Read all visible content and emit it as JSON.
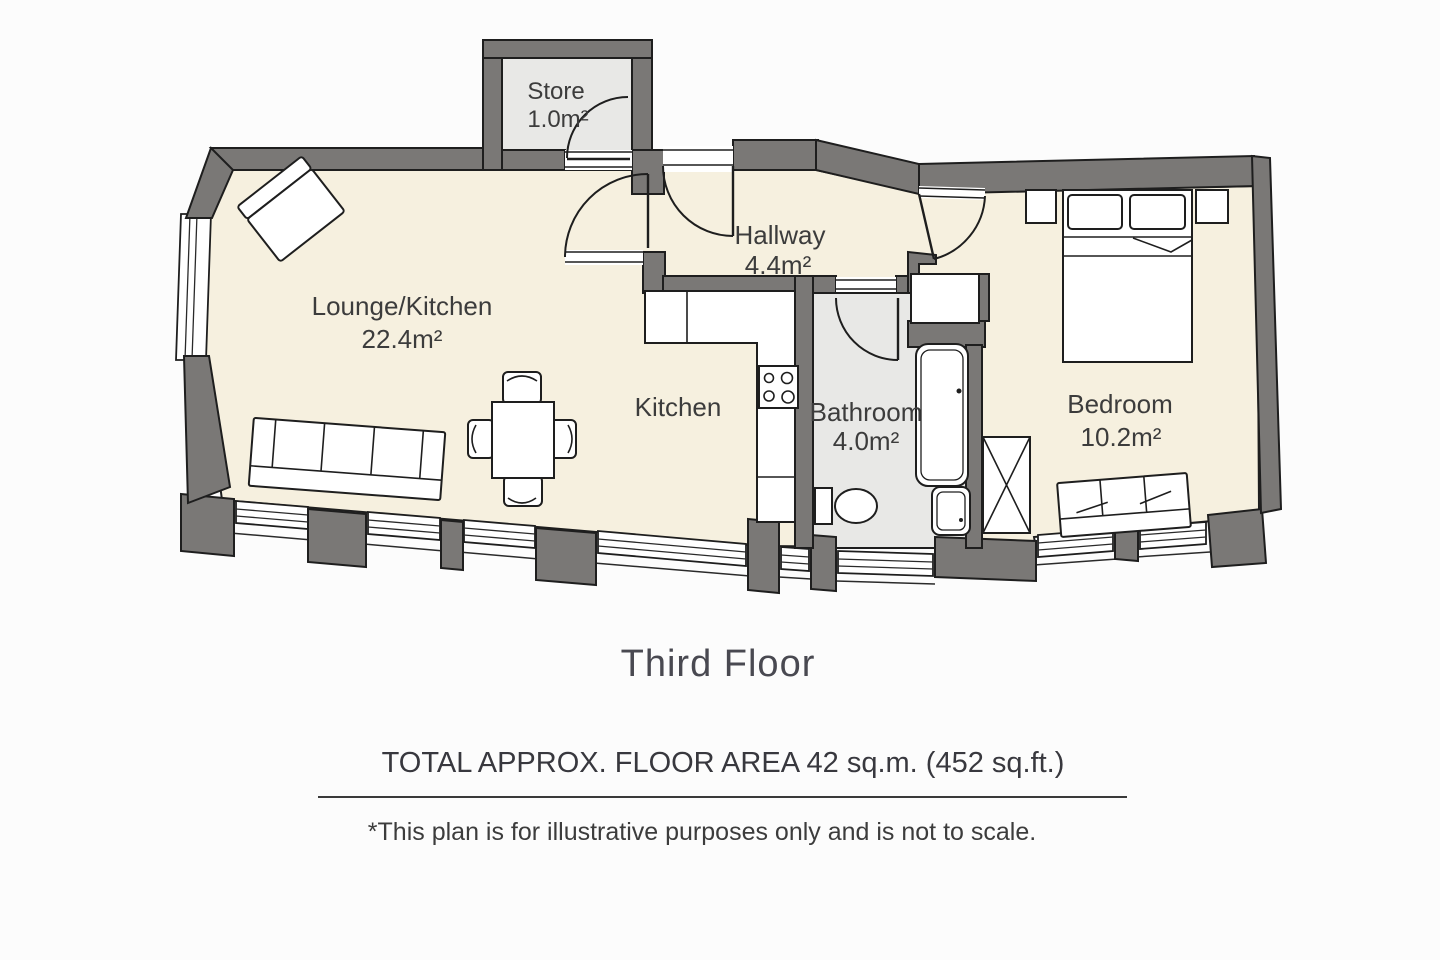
{
  "plan": {
    "rooms": {
      "store": {
        "name": "Store",
        "area": "1.0m²"
      },
      "hallway": {
        "name": "Hallway",
        "area": "4.4m²"
      },
      "lounge_kitchen": {
        "name": "Lounge/Kitchen",
        "area": "22.4m²"
      },
      "kitchen": {
        "name": "Kitchen"
      },
      "bathroom": {
        "name": "Bathroom",
        "area": "4.0m²"
      },
      "bedroom": {
        "name": "Bedroom",
        "area": "10.2m²"
      }
    }
  },
  "footer": {
    "floor_title": "Third Floor",
    "total_area": "TOTAL APPROX. FLOOR AREA 42 sq.m. (452 sq.ft.)",
    "disclaimer": "*This plan is for illustrative purposes only and is not to scale."
  },
  "colors": {
    "wall": "#7a7876",
    "floor": "#f6f0df",
    "wet_floor": "#e8e8e6",
    "outline": "#1e1e1e",
    "text": "#3c3c3c",
    "background": "#fcfcfc"
  }
}
